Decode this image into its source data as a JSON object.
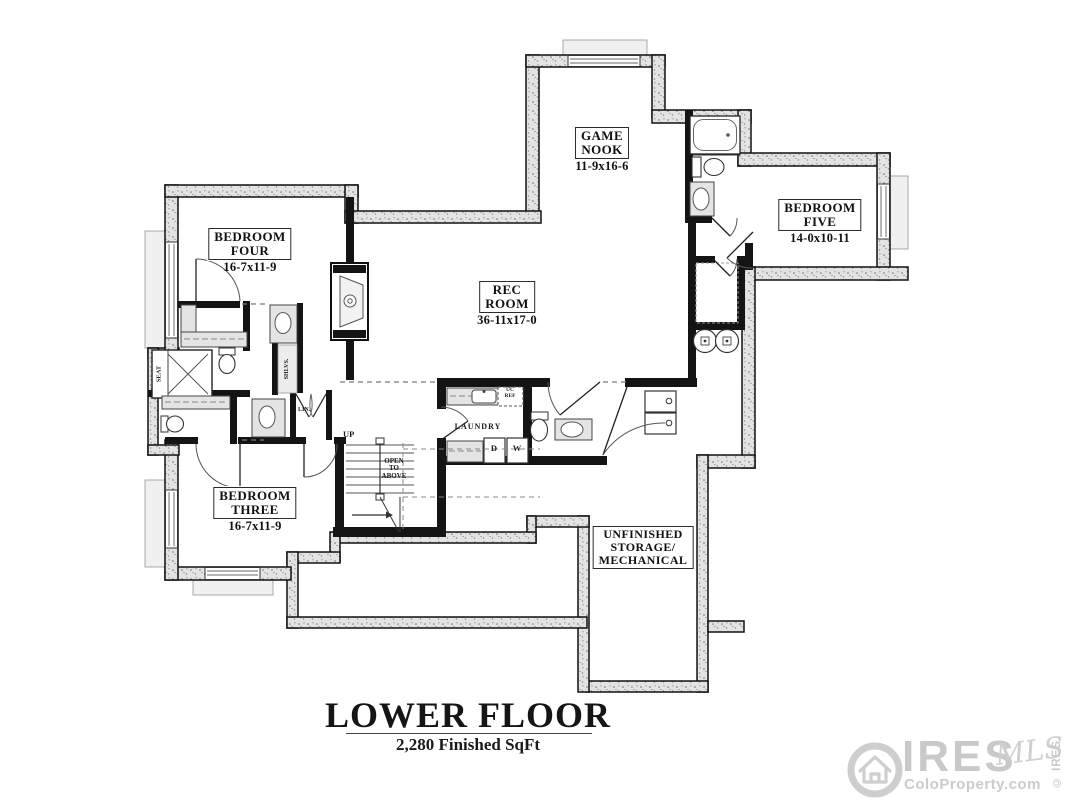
{
  "floor_plan": {
    "rooms": [
      {
        "id": "game-nook",
        "line1": "GAME",
        "line2": "NOOK",
        "line3": "",
        "dims": "11-9x16-6"
      },
      {
        "id": "bedroom-five",
        "line1": "BEDROOM",
        "line2": "FIVE",
        "line3": "",
        "dims": "14-0x10-11"
      },
      {
        "id": "bedroom-four",
        "line1": "BEDROOM",
        "line2": "FOUR",
        "line3": "",
        "dims": "16-7x11-9"
      },
      {
        "id": "rec-room",
        "line1": "REC",
        "line2": "ROOM",
        "line3": "",
        "dims": "36-11x17-0"
      },
      {
        "id": "bedroom-three",
        "line1": "BEDROOM",
        "line2": "THREE",
        "line3": "",
        "dims": "16-7x11-9"
      },
      {
        "id": "unfinished-storage",
        "line1": "UNFINISHED",
        "line2": "STORAGE/",
        "line3": "MECHANICAL",
        "dims": ""
      }
    ],
    "labels": {
      "up": "UP",
      "open1": "OPEN",
      "open2": "TO",
      "open3": "ABOVE",
      "laundry": "LAUNDRY",
      "dryer": "D",
      "washer": "W",
      "ucref1": "UC",
      "ucref2": "REF",
      "lin": "LIN.",
      "shlvs": "SHLVS.",
      "seat": "SEAT"
    }
  },
  "title": {
    "main": "LOWER FLOOR",
    "subtitle": "2,280 Finished SqFt"
  },
  "logo": {
    "brand": "IRES",
    "script": "MLS",
    "site": "ColoProperty.com",
    "copyright": "© IRES"
  },
  "colors": {
    "wall": "#141414",
    "stipple_fill": "#e3e3e3",
    "fixture_fill": "#e4e4e4",
    "window": "#9a9a9a",
    "logo_gray": "#c9c9c9"
  }
}
